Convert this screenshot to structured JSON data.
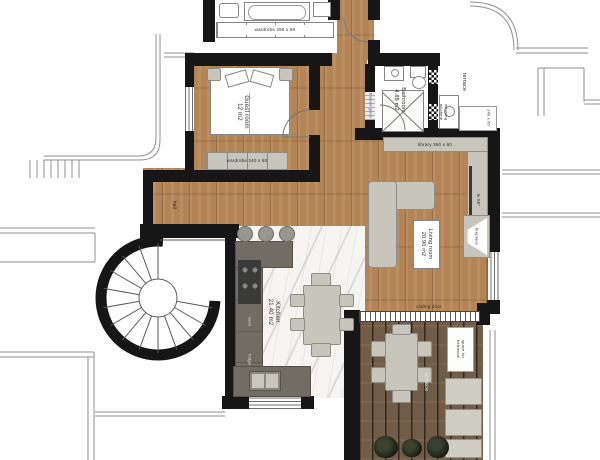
{
  "plan": {
    "rooms": {
      "guest_room": {
        "label": "Guest room\n12 m2"
      },
      "bathroom": {
        "label": "Bathroom\n4.88 m2"
      },
      "living_room": {
        "label": "Living room\n20.90 m2"
      },
      "kitchen": {
        "label": "Kitchen\n21.40 m2"
      },
      "hall": {
        "label": "hall"
      },
      "terrace_upper": {
        "label": "terrace"
      },
      "terrace_lower": {
        "label": "terrace"
      }
    },
    "fixtures": {
      "wardrobe_top": "wardrobe 290 x 60",
      "wardrobe_guest": "wardrobe 240 x 60",
      "library": "library 360 x 60",
      "washing_machine": "washing machine",
      "terrace_cabinet": "140 x 60",
      "frosted_glass": "frosted glass",
      "tv": "tv 55\"",
      "fireplace": "fireplace",
      "oven": "oven",
      "fridge": "fridge",
      "sliding_door": "sliding door",
      "barbecue": "space for\nbarbecue"
    },
    "colors": {
      "wall": "#161616",
      "wood": "#b28456",
      "deck": "#705c47",
      "marble": "#f6f5f2",
      "furniture": "#c8c5bc",
      "counter": "#716d65",
      "thinline": "#8f8f8f"
    }
  }
}
